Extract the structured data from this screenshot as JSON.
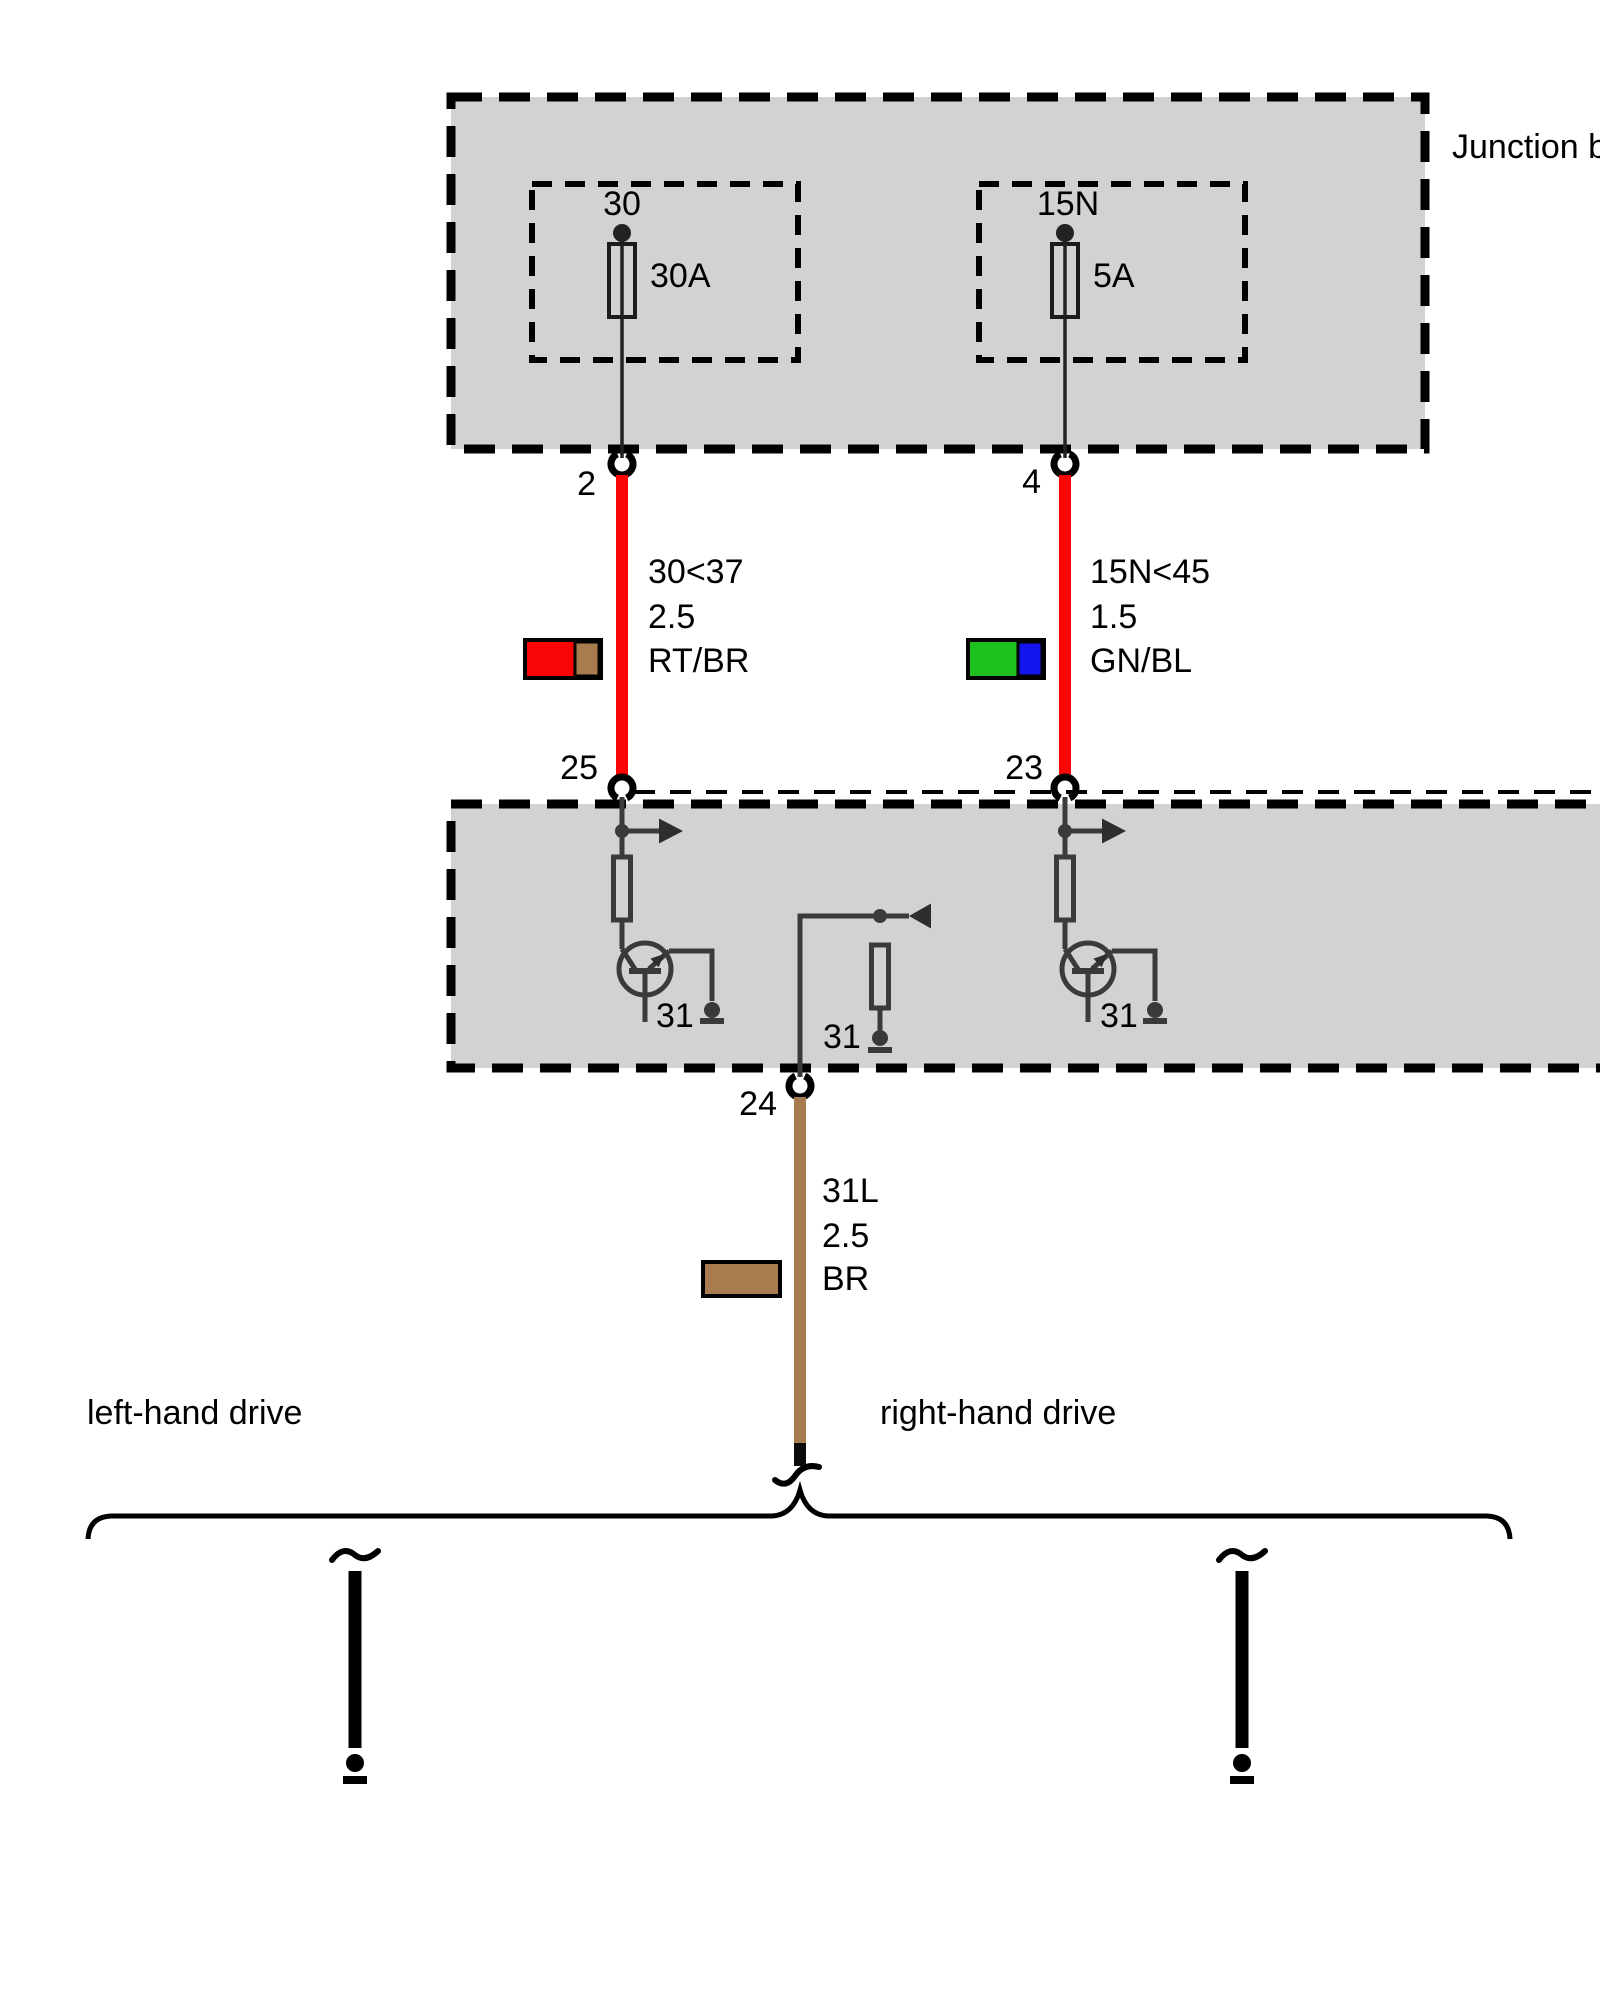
{
  "diagram_title": "Junction box",
  "junction_box": {
    "fuses": [
      {
        "terminal": "30",
        "rating": "30A"
      },
      {
        "terminal": "15N",
        "rating": "5A"
      }
    ],
    "output_pins": [
      "2",
      "4"
    ]
  },
  "control_module": {
    "input_pins": [
      "25",
      "23"
    ],
    "output_pin": "24",
    "ground_labels": [
      "31",
      "31",
      "31"
    ]
  },
  "wires": [
    {
      "circuit": "30<37",
      "cross_section": "2.5",
      "color_code": "RT/BR"
    },
    {
      "circuit": "15N<45",
      "cross_section": "1.5",
      "color_code": "GN/BL"
    },
    {
      "circuit": "31L",
      "cross_section": "2.5",
      "color_code": "BR"
    }
  ],
  "variant_labels": {
    "left": "left-hand drive",
    "right": "right-hand drive"
  },
  "colors": {
    "box_fill": "#D2D2D2",
    "red": "#FA0505",
    "brown": "#A97C50",
    "green": "#1EC01E",
    "blue": "#1515EE"
  }
}
